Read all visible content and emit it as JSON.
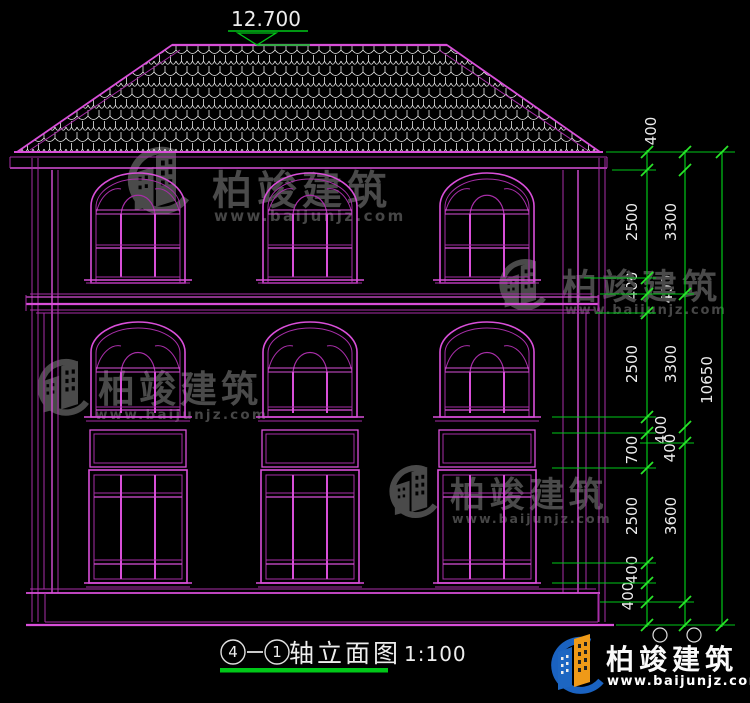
{
  "drawing": {
    "elevation_top": "12.700",
    "title": {
      "axis_start": "4",
      "axis_end": "1",
      "name": "轴立面图",
      "scale": "1:100"
    }
  },
  "dims": {
    "top": "400",
    "inner": [
      "2500",
      "400",
      "2500",
      "700",
      "2500",
      "400",
      "400"
    ],
    "between": [
      "400",
      "400",
      "400"
    ],
    "middle": [
      "3300",
      "3300",
      "3600"
    ],
    "total": "10650"
  },
  "watermark": {
    "brand": "柏竣建筑",
    "url": "www.baijunjz.com"
  },
  "footer": {
    "brand": "柏竣建筑",
    "url": "www.baijunjz.com"
  },
  "colors": {
    "line": "#d94fd9",
    "dim": "#00c818",
    "text": "#ededed",
    "watermark": "#4a4a4a",
    "logo_blue": "#1a62c0",
    "logo_orange": "#ef9a18"
  }
}
